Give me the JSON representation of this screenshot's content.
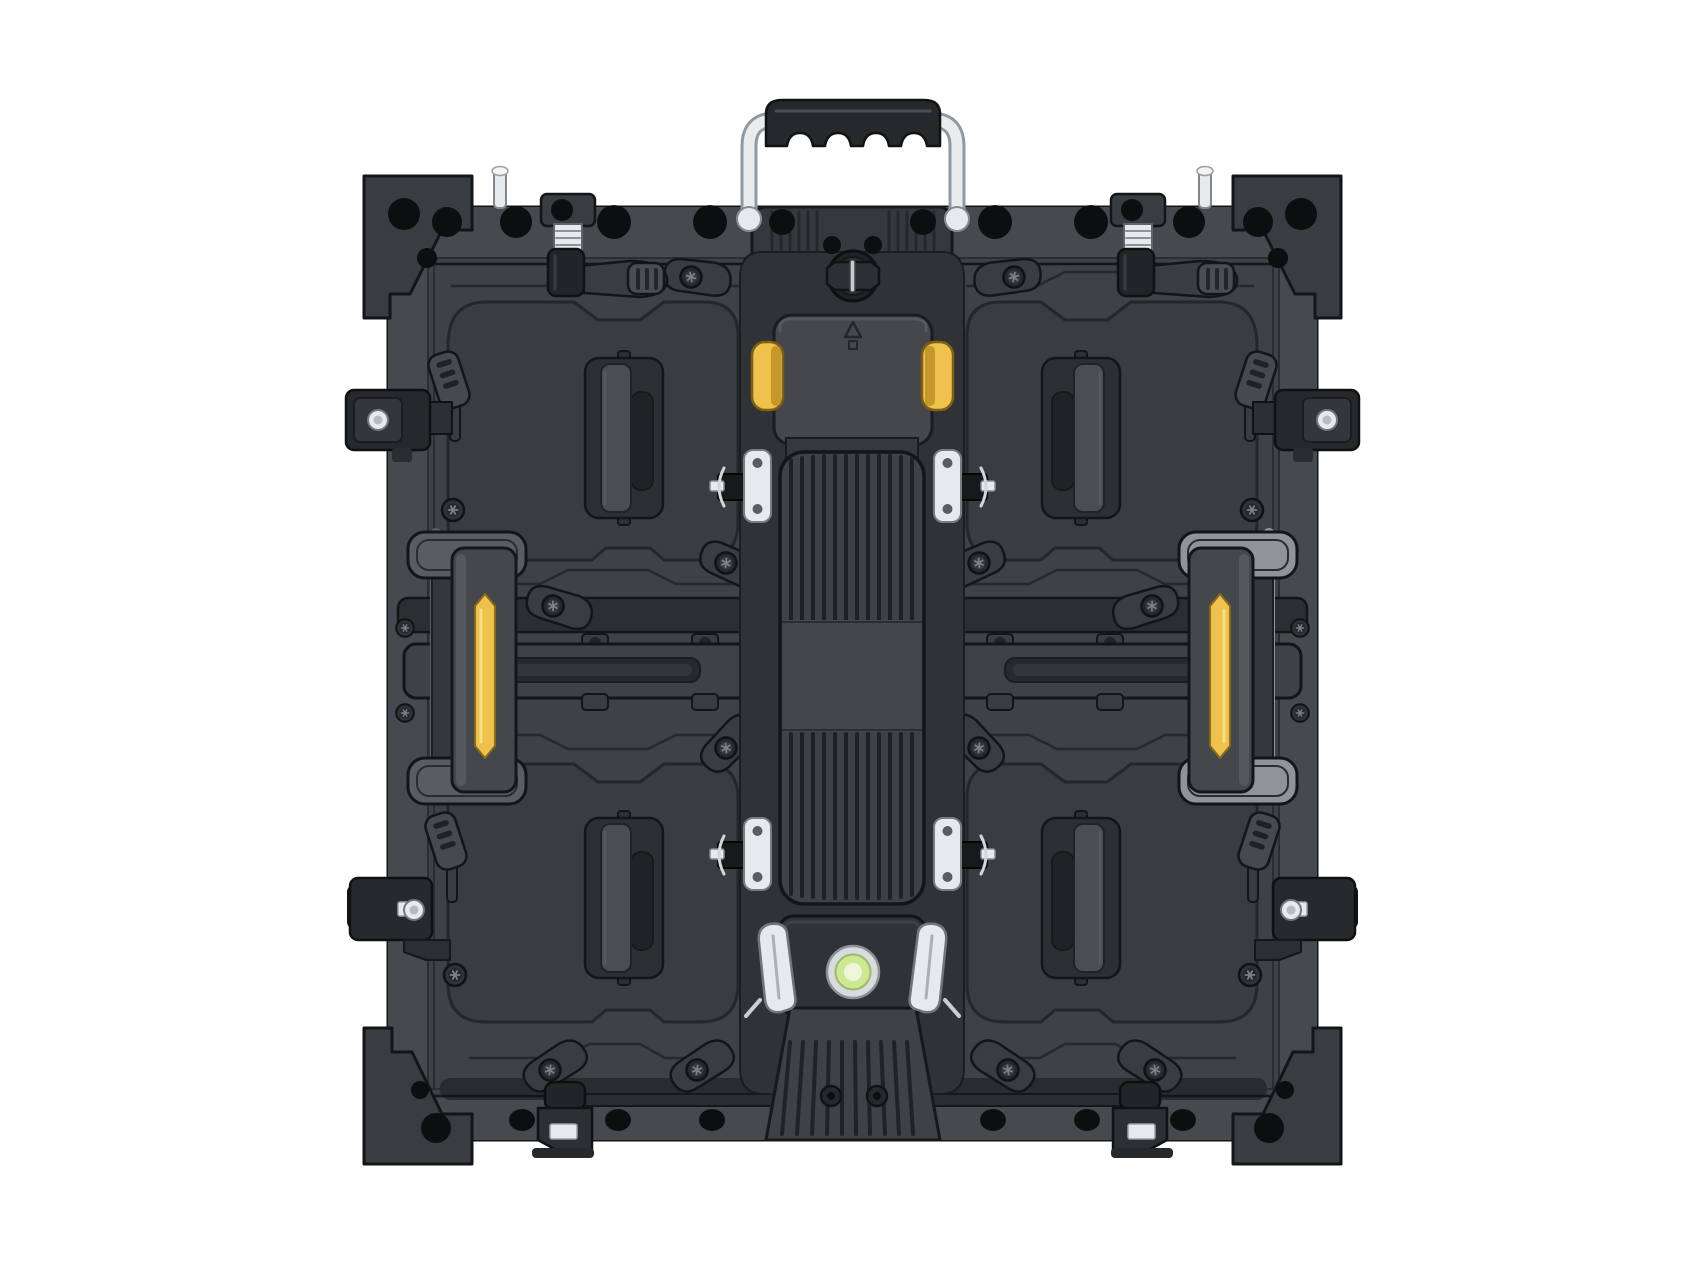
{
  "image": {
    "type": "product-photograph",
    "subject": "Rear view of a square die-cast aluminium LED video-wall display panel cabinet with chrome carry handle, four quadrant pull handles, yellow side lock handles and a central ribbed power module",
    "background": "plain white studio background"
  },
  "colors": {
    "white": "#ffffff",
    "panel": "#3e4145",
    "panel2": "#46494d",
    "quad": "#393c40",
    "recess": "#2f3236",
    "dark": "#26292c",
    "plate": "#2d3033",
    "gripbar": "#4a4e52",
    "cavity": "#202326",
    "hole": "#0c0e10",
    "outline": "#131518",
    "engrave": "#26282b",
    "chrome": "#e7eaec",
    "chromeDark": "#8f969c",
    "yellow": "#eec24d",
    "yellowShade": "#c6982b",
    "grip": "#26292b",
    "green": "#cde893",
    "greenPale": "#eef5da",
    "levelRing": "#d8dcdf",
    "flangeLeft": "#62666b",
    "flangeRight": "#8f9499"
  },
  "components": {
    "carry_handle": {
      "count": 1,
      "finish": "chrome tube with black rubber wave grip",
      "position": "top center"
    },
    "top_twist_lock": {
      "count": 1,
      "position": "top center of cabinet below handle"
    },
    "corner_brackets": {
      "count": 4,
      "detail": "chamfered corner blocks with through-holes"
    },
    "top_latch_assemblies": {
      "count": 2,
      "detail": "threaded chrome barrel with ribbed trigger lever"
    },
    "quadrant_pull_handles": {
      "count": 4,
      "detail": "recessed vertical pull handle in each quadrant"
    },
    "side_lock_handles": {
      "count": 2,
      "accent": "vertical yellow insert strip",
      "position": "left and right mid edges"
    },
    "top_yellow_clips": {
      "count": 2,
      "position": "either side of center module cap"
    },
    "center_power_module": {
      "count": 1,
      "detail": "vertical ribbed housing with smooth mid band"
    },
    "spring_latches": {
      "count": 4,
      "finish": "chrome plates with black cam blocks beside center module"
    },
    "spirit_level": {
      "count": 1,
      "color": "green bubble vial",
      "position": "bottom center module"
    },
    "bottom_edge_clamps": {
      "count": 2,
      "detail": "black bracket with white nylon insert"
    },
    "wing_cam_levers": {
      "count": 12,
      "detail": "teardrop cams with torx screws"
    },
    "mid_rails": {
      "count": 2,
      "detail": "horizontal slotted connecting rails toward center"
    }
  }
}
